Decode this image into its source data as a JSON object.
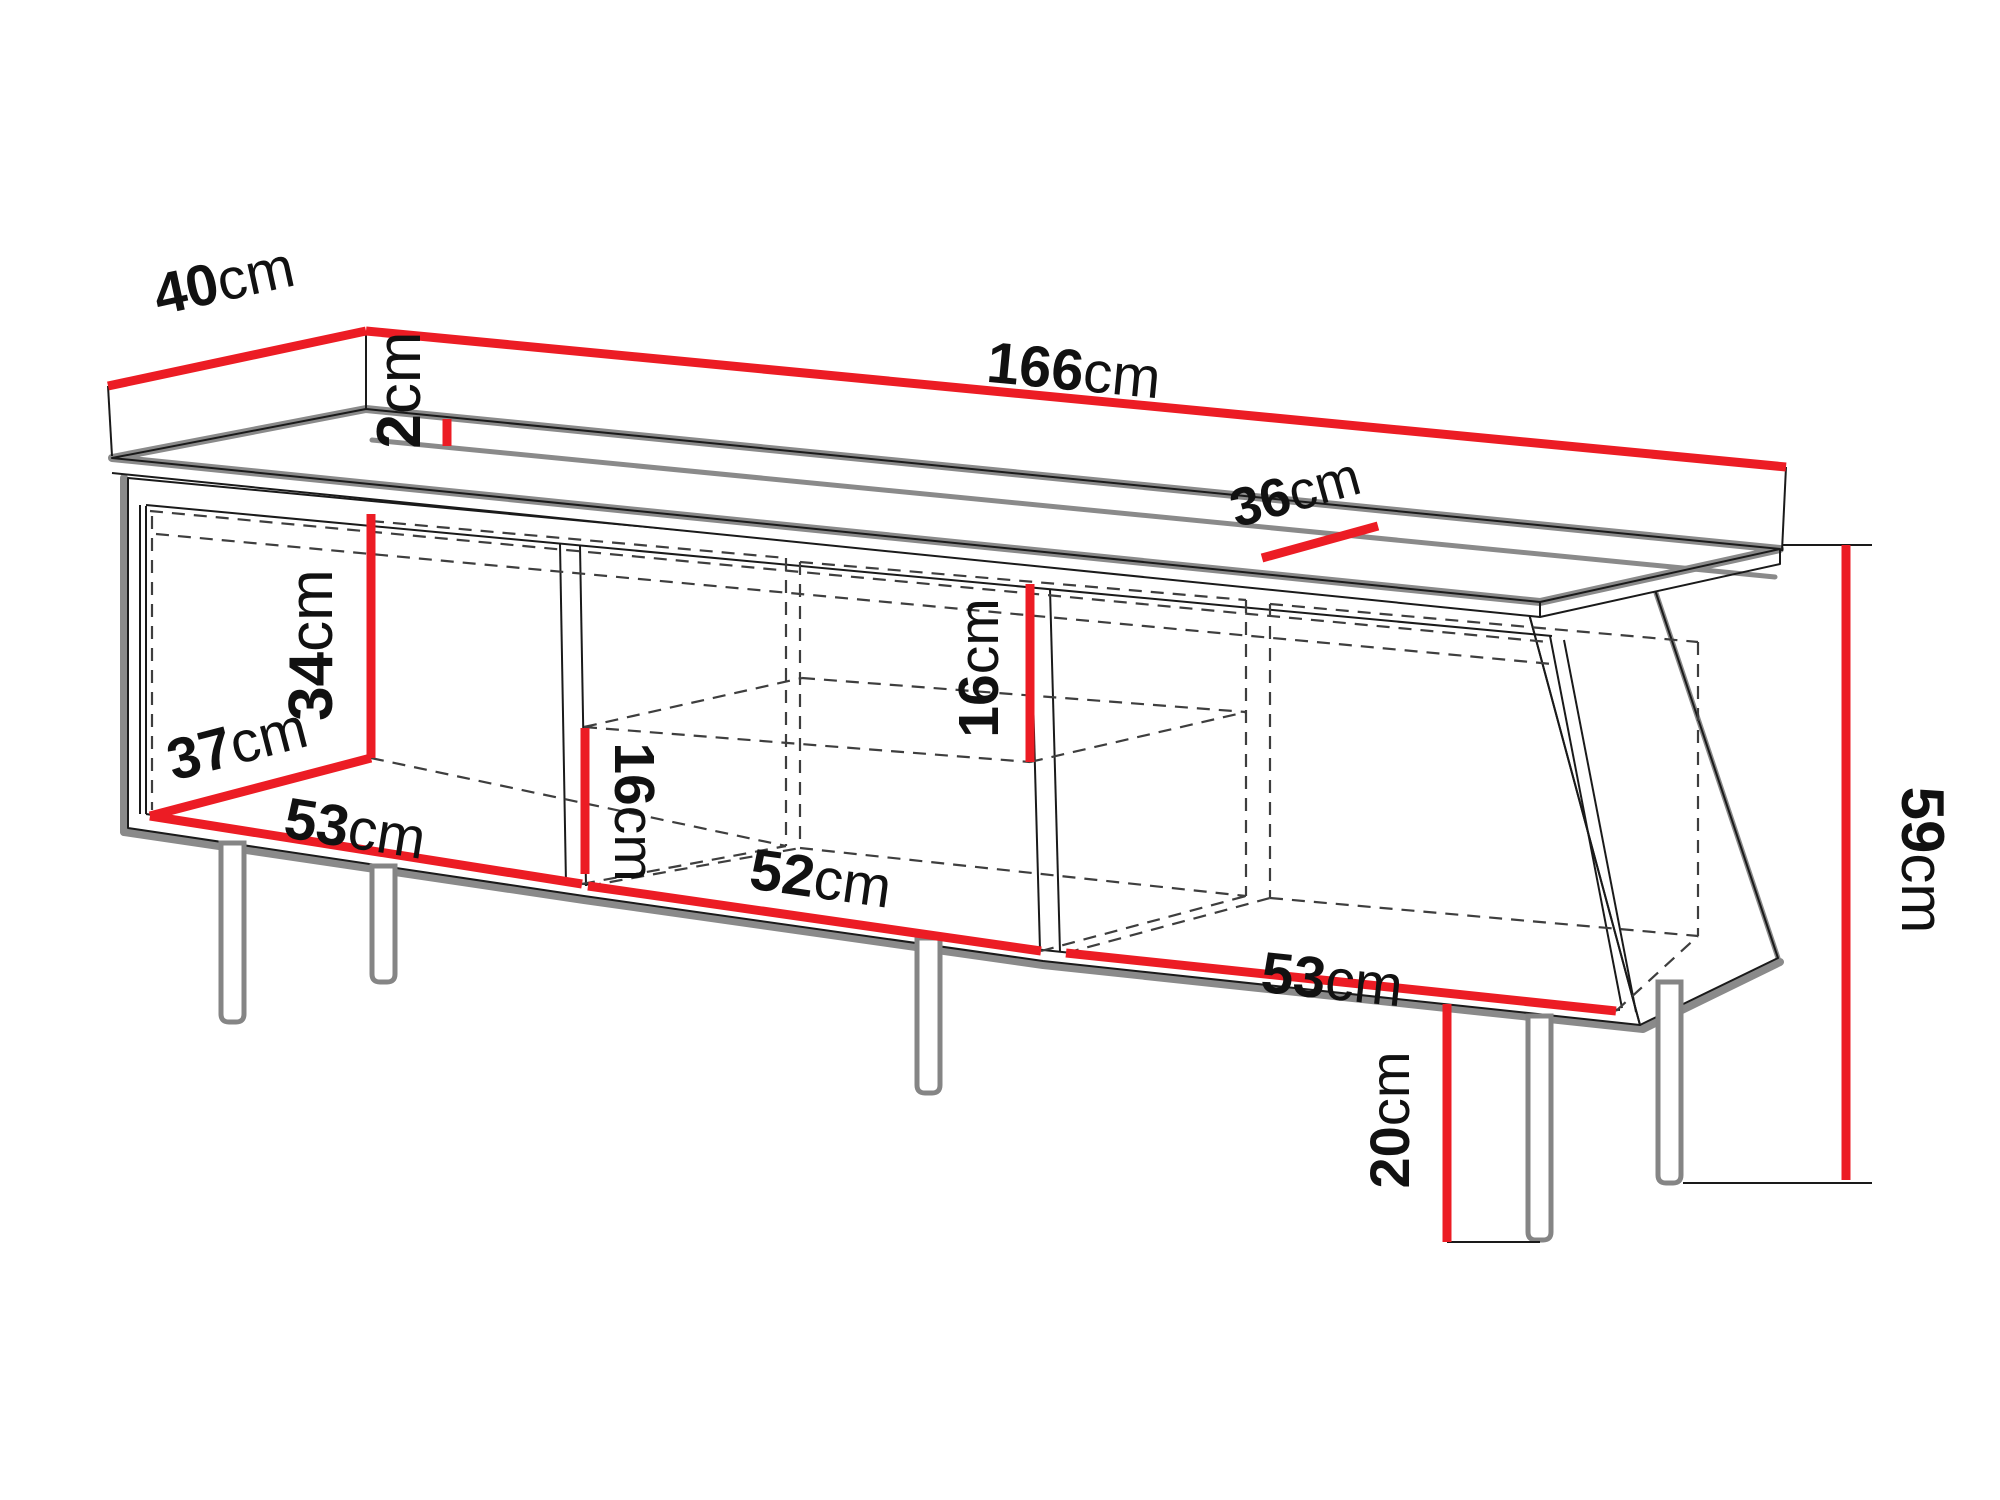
{
  "diagram": {
    "kind": "furniture dimension drawing",
    "subject": "TV cabinet with three open compartments, middle shelf and tall legs",
    "unit": "cm",
    "colors": {
      "background": "#ffffff",
      "dimension_line": "#ec1c24",
      "outline": "#1a1a1a",
      "shading": "#8a8a8a",
      "label_text": "#111111"
    }
  },
  "labels": {
    "depth_top": {
      "value": "40",
      "unit": "cm"
    },
    "top_thickness": {
      "value": "2",
      "unit": "cm"
    },
    "total_width": {
      "value": "166",
      "unit": "cm"
    },
    "inner_top_depth": {
      "value": "36",
      "unit": "cm"
    },
    "left_inner_height": {
      "value": "34",
      "unit": "cm"
    },
    "left_inner_depth": {
      "value": "37",
      "unit": "cm"
    },
    "left_inner_width": {
      "value": "53",
      "unit": "cm"
    },
    "middle_upper_height": {
      "value": "16",
      "unit": "cm"
    },
    "middle_lower_height": {
      "value": "16",
      "unit": "cm"
    },
    "middle_inner_width": {
      "value": "52",
      "unit": "cm"
    },
    "right_inner_width": {
      "value": "53",
      "unit": "cm"
    },
    "total_height": {
      "value": "59",
      "unit": "cm"
    },
    "leg_height": {
      "value": "20",
      "unit": "cm"
    }
  }
}
